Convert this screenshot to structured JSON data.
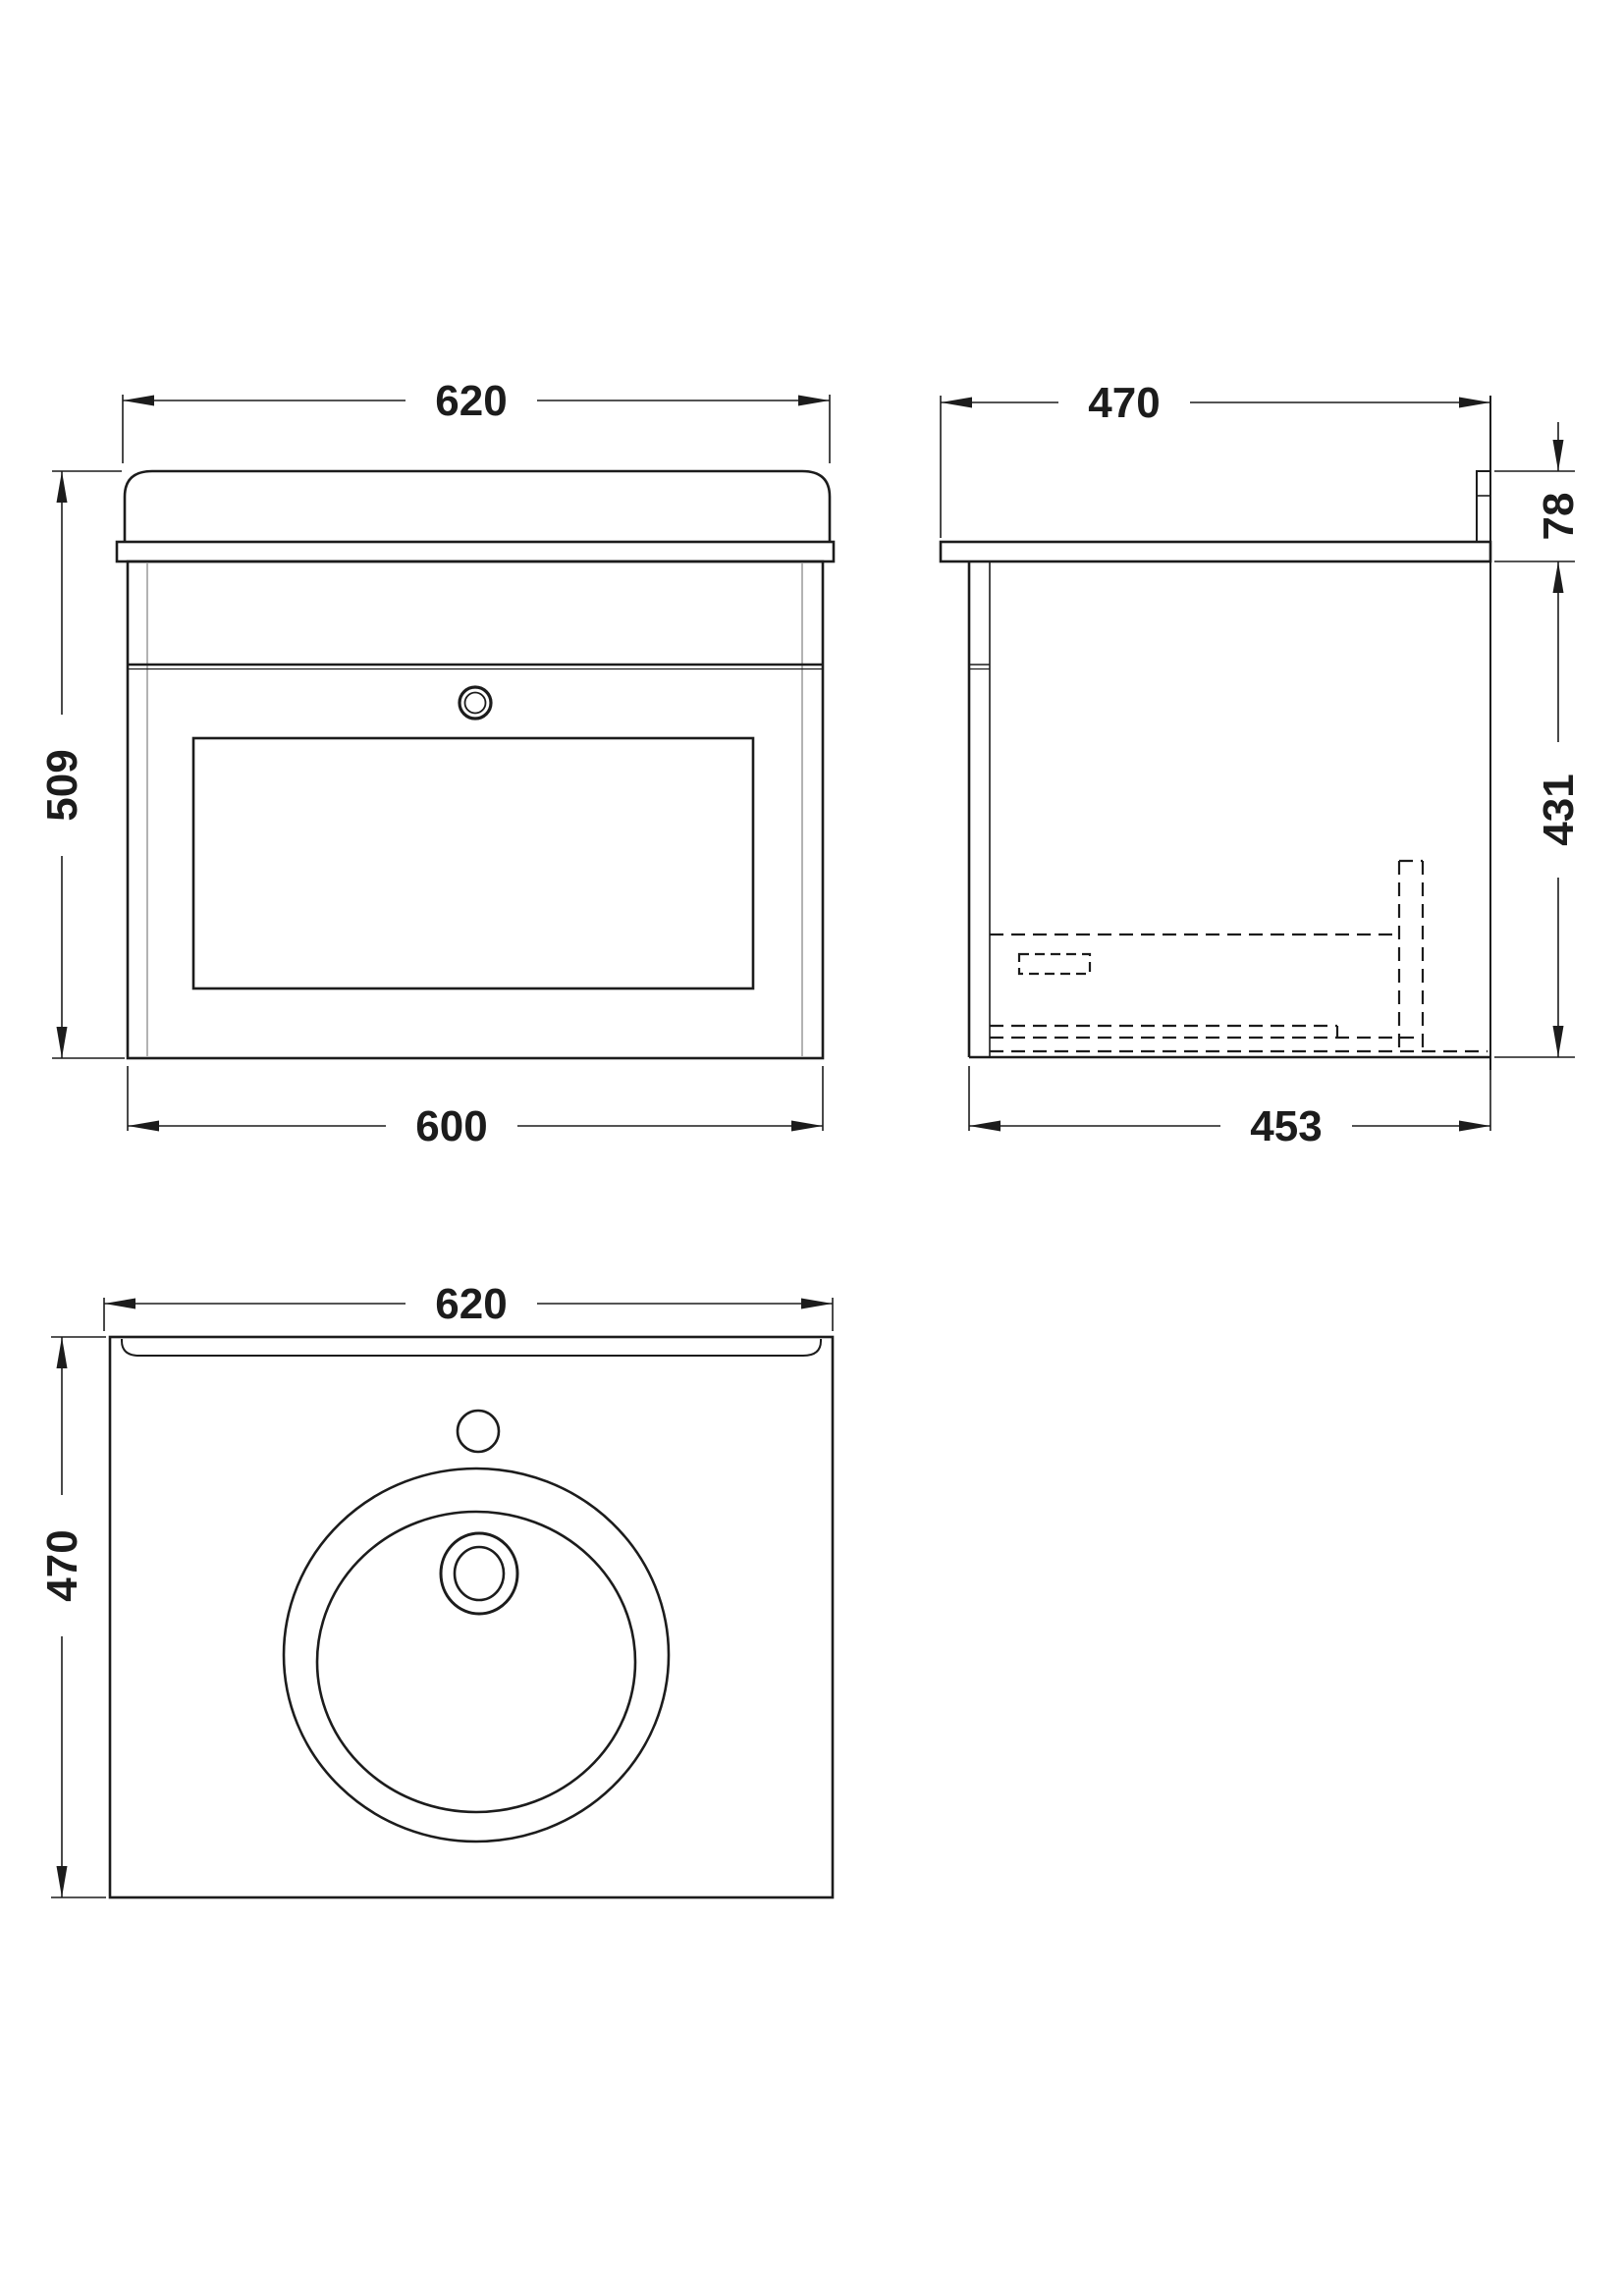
{
  "drawing_title": "wall-hung-vanity-unit-with-basin-technical-drawing",
  "palette": {
    "line_color": "#1c1c1c",
    "panel_line_color": "#9a9a9a",
    "background": "#ffffff"
  },
  "views": {
    "front": {
      "label": "front-view",
      "width_top": "620",
      "height_left": "509",
      "width_bottom": "600"
    },
    "side": {
      "label": "side-view",
      "depth_top": "470",
      "upstand_height": "78",
      "cabinet_height": "431",
      "depth_bottom": "453"
    },
    "plan": {
      "label": "plan-view",
      "width_top": "620",
      "depth_left": "470"
    }
  }
}
